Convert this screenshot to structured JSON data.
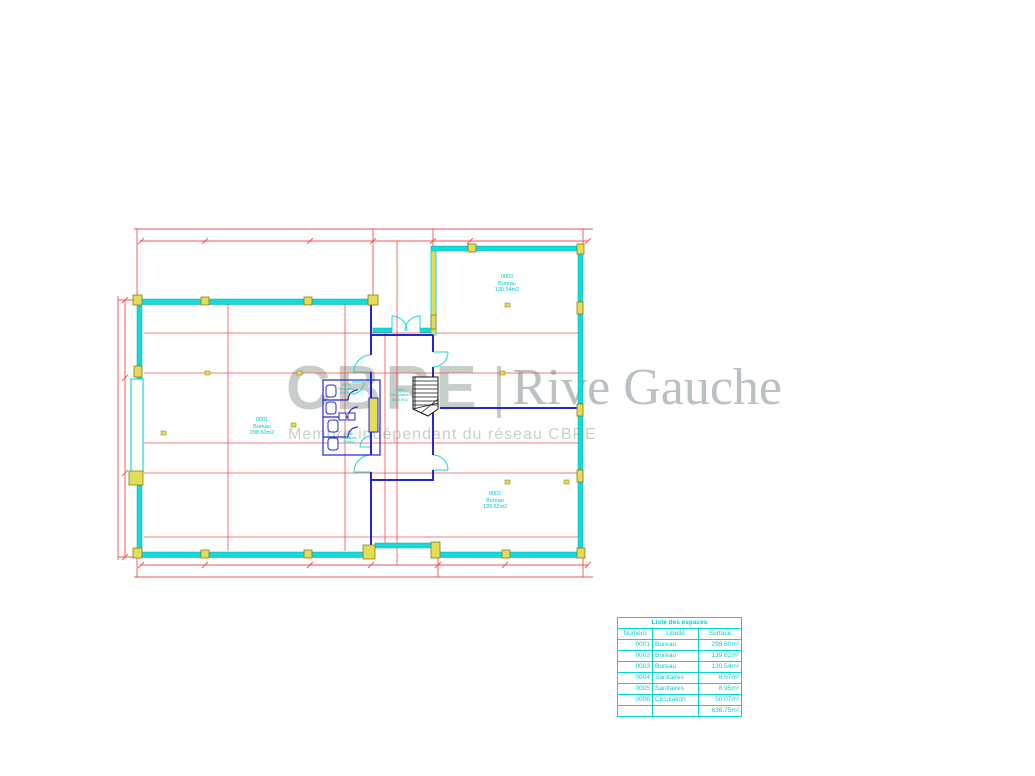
{
  "watermark": {
    "brand": "CBRE",
    "brand_right": "Rive Gauche",
    "tagline": "Membre indépendant du réseau CBRE"
  },
  "rooms": [
    {
      "id": "0001",
      "name": "Bureau",
      "area": "298.60m2"
    },
    {
      "id": "0003",
      "name": "Bureau",
      "area": "130.54m2"
    },
    {
      "id": "0002",
      "name": "Bureau",
      "area": "139.62m2"
    },
    {
      "id": "0004",
      "name": "Sanitaires",
      "area": "8.97m2"
    },
    {
      "id": "0005",
      "name": "Sanitaires",
      "area": "8.95m2"
    },
    {
      "id": "0006",
      "name": "Circulation",
      "area": "50.07m2"
    }
  ],
  "space_table": {
    "title": "Liste des espaces",
    "columns": [
      "Numéro",
      "Libellé",
      "Surface"
    ],
    "rows": [
      [
        "0001",
        "Bureau",
        "298.60m²"
      ],
      [
        "0002",
        "Bureau",
        "139.62m²"
      ],
      [
        "0003",
        "Bureau",
        "130.54m²"
      ],
      [
        "0004",
        "Sanitaires",
        "8.97m²"
      ],
      [
        "0005",
        "Sanitaires",
        "8.95m²"
      ],
      [
        "0006",
        "Circulation",
        "50.07m²"
      ]
    ],
    "total_surface": "636.75m²"
  },
  "colors": {
    "walls": "#17d9d9",
    "partitions": "#2626cc",
    "grid_lines": "#f25050",
    "columns": "#e3dc55",
    "labels": "#00c9c9",
    "watermark": "#c7cec9"
  }
}
